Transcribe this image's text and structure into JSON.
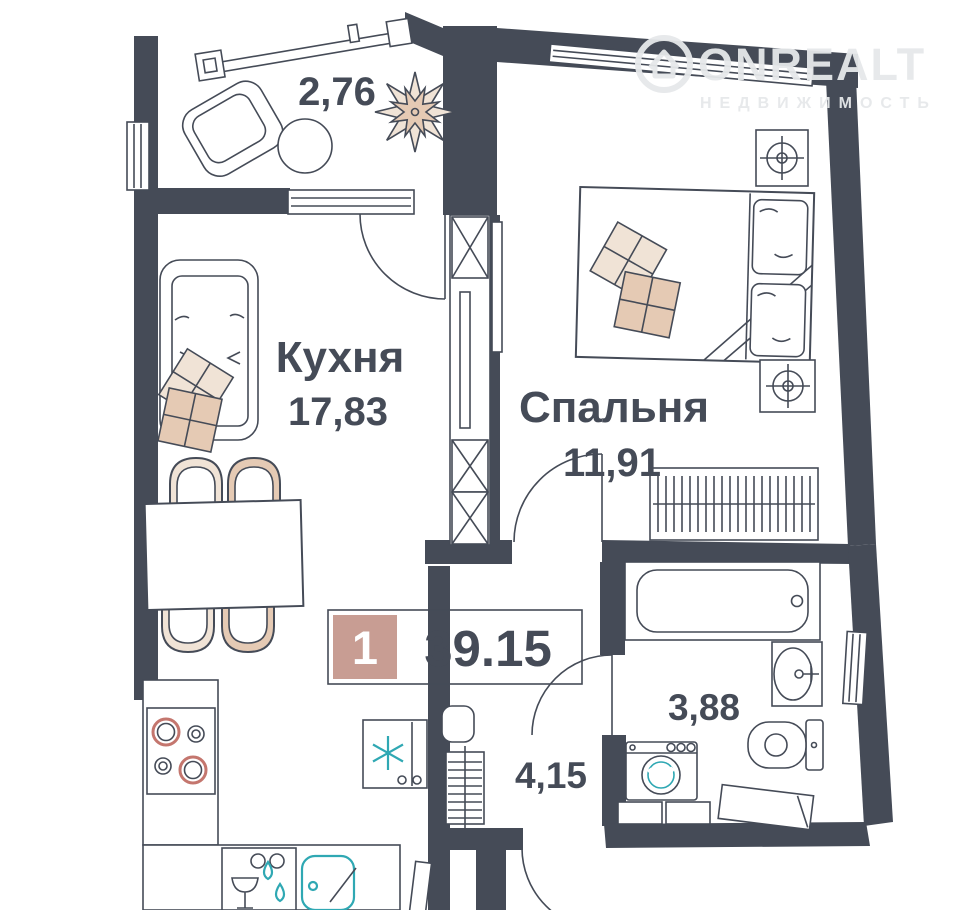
{
  "logo": {
    "brand": "ONREALT",
    "subtitle": "НЕДВИЖИМОСТЬ"
  },
  "badge": {
    "room_count": "1",
    "total_area": "39.15"
  },
  "rooms": {
    "balcony": {
      "area": "2,76"
    },
    "kitchen": {
      "name": "Кухня",
      "area": "17,83"
    },
    "bedroom": {
      "name": "Спальня",
      "area": "11,91"
    },
    "bathroom": {
      "area": "3,88"
    },
    "hallway": {
      "area": "4,15"
    }
  },
  "colors": {
    "wall": "#454b57",
    "accent_pink": "#c89d93",
    "accent_teal": "#2fa8b3",
    "beige_light": "#f0e3d6",
    "beige_dark": "#e5cab4",
    "stove_ring": "#c4766e",
    "logo_gray": "#e6e8ea"
  },
  "icons": {
    "house-logo-icon": "house-in-circle",
    "plant-icon": "eight-petal-flower",
    "snowflake-icon": "six-arm-asterisk",
    "wine-glass-icon": "triangle-on-stem",
    "water-drops-icon": "two-teardrops",
    "ceiling-light-icon": "concentric-circles-with-cross",
    "burner-icon": "double-circle",
    "hanger-rail-icon": "vertical-hatch",
    "vent-shaft-icon": "crossed-box"
  }
}
